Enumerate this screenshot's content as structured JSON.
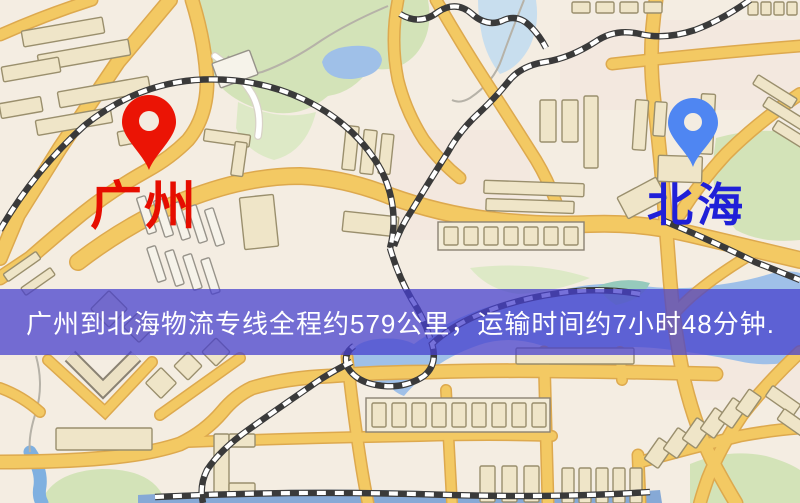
{
  "map": {
    "banner": {
      "text": "广州到北海物流专线全程约579公里，运输时间约7小时48分钟.",
      "bg_rgba": "rgba(70,63,205,0.74)",
      "text_color": "#ffffff",
      "top_px": 289,
      "height_px": 66,
      "font_px": 26
    },
    "origin": {
      "name": "广州",
      "pin_color": "#eb1405",
      "label_color": "#e60d00"
    },
    "destination": {
      "name": "北海",
      "pin_color": "#4f86f2",
      "label_color": "#2020d8"
    },
    "palette": {
      "background": "#f4ede2",
      "road_major": "#f3c963",
      "road_casing": "#dda94e",
      "road_minor": "#ffffff",
      "road_minor_casing": "#d8d2c6",
      "park": "#d3e3b8",
      "park_light": "#dde9c6",
      "water": "#9fc0e8",
      "water_light": "#c8deee",
      "water_teal": "#96cabc",
      "stream": "#7fb0e0",
      "contour": "#b6b2a8",
      "railway_dark": "#3a3a3a",
      "railway_light": "#ffffff",
      "building": "#efe5c8",
      "building_stroke": "#9a8f6d",
      "building_white": "#f6f3ea",
      "building_white_stroke": "#97938a",
      "pin_hole": "#f3ece1"
    }
  }
}
